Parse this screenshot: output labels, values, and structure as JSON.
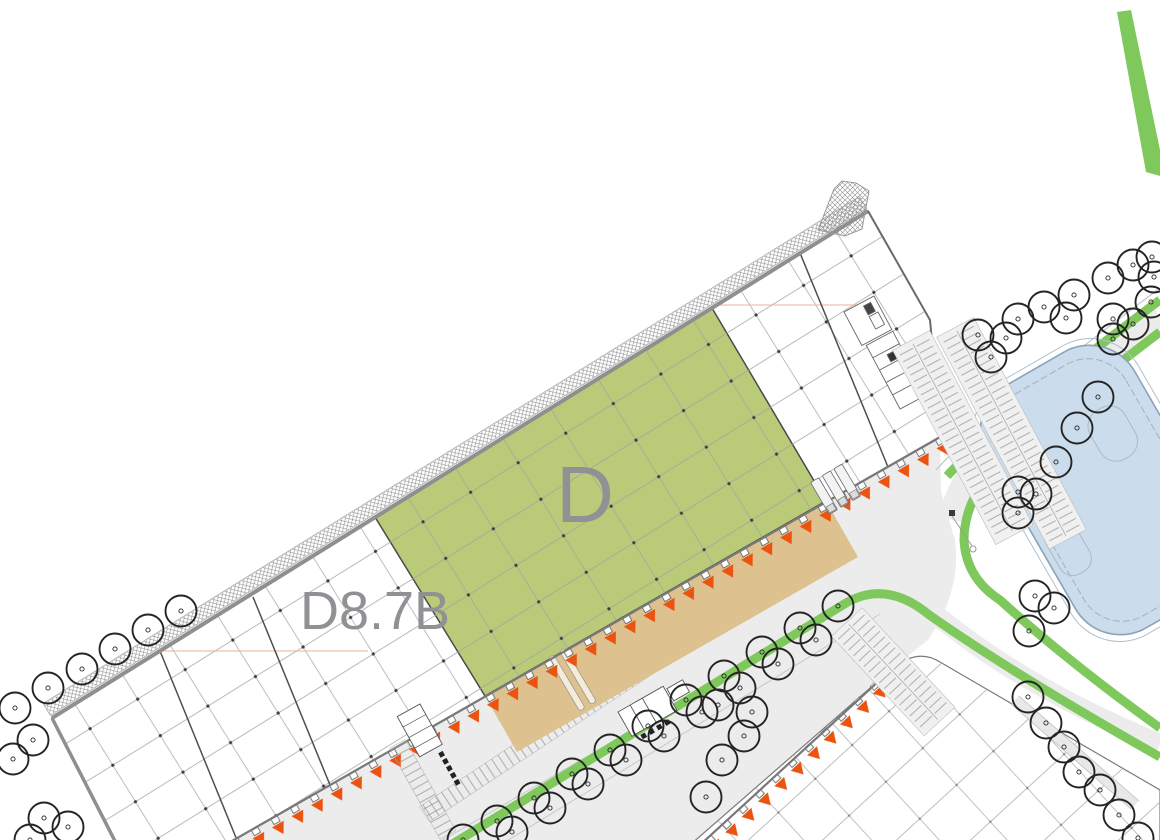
{
  "plan": {
    "unit_label": "D",
    "building_label": "D8.7B"
  },
  "colors": {
    "unit_green": "#b9ca79",
    "apron_tan": "#ddc28f",
    "dock_orange": "#ea5310",
    "landscape_green": "#7fc85c",
    "pond_fill": "#cbdcec",
    "pond_edge": "#8aa3b9",
    "pavement_gray": "#ececec",
    "wall_gray": "#8f8f8f",
    "outline_dark": "#4a4a4a",
    "label_gray": "#8f9194",
    "grid_line": "#a2a2a2",
    "tree_outline": "#242424"
  }
}
